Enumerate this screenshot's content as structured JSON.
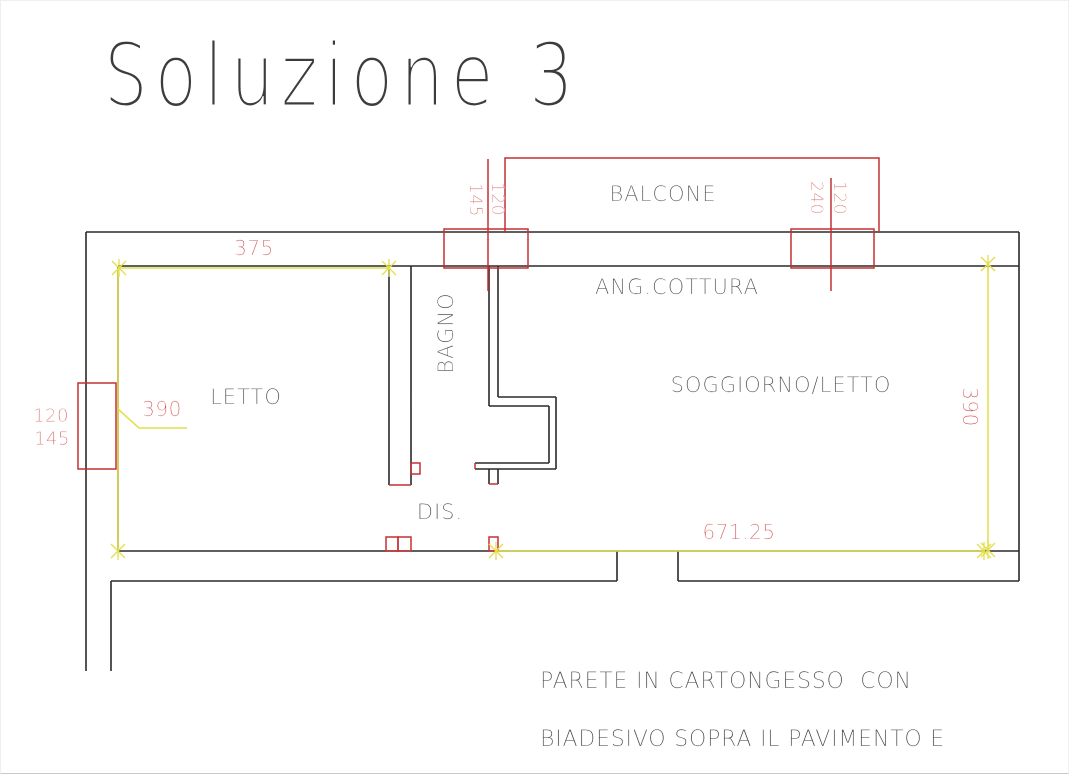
{
  "title": "Soluzione 3",
  "colors": {
    "wall": "#2a2a2a",
    "red": "#c43032",
    "red_text": "#ce4747",
    "yellow": "#e4df4e",
    "ink": "#3a3a3a"
  },
  "rooms": {
    "balcone": "BALCONE",
    "ang_cottura": "ANG.COTTURA",
    "bagno": "BAGNO",
    "letto": "LETTO",
    "soggiorno": "SOGGIORNO/LETTO",
    "dis": "DIS."
  },
  "dimensions": {
    "letto_width": "375",
    "letto_height": "390",
    "soggiorno_height": "390",
    "soggiorno_width": "671.25",
    "left_window": {
      "width": "120",
      "height": "145"
    },
    "balcony_window_left": {
      "width": "120",
      "height": "145"
    },
    "balcony_door_right": {
      "width": "120",
      "height": "240"
    }
  },
  "note": {
    "line1": "PARETE IN CARTONGESSO  CON",
    "line2": "BIADESIVO SOPRA IL PAVIMENTO E",
    "line3": "PORTA SCORREVOLE"
  }
}
